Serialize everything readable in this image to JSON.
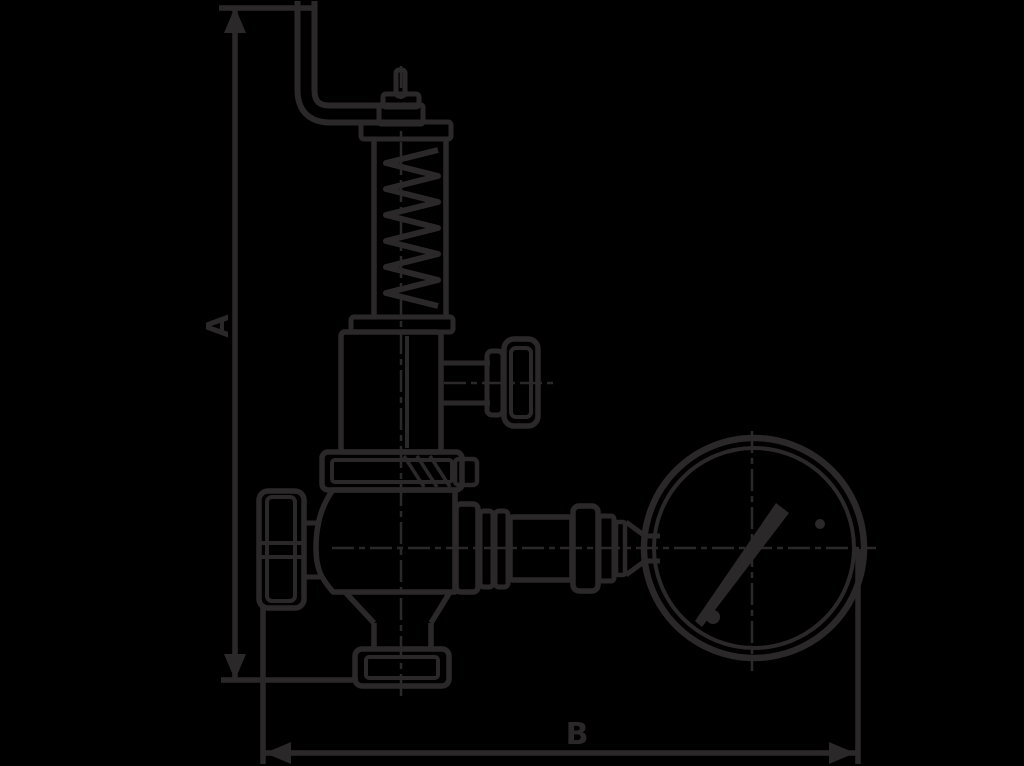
{
  "figure": {
    "type": "technical line drawing",
    "background_color": "#000000",
    "line_color": "#2b2829"
  },
  "dimensions": {
    "vertical_label": "A",
    "horizontal_label": "B"
  },
  "components": [
    "lifting-lever-bracket",
    "adjusting-pin",
    "spring-housing",
    "coil-spring",
    "bonnet",
    "side-port-knob",
    "upper-flange",
    "valve-body",
    "left-hand-knob",
    "bottom-outlet-flange",
    "pipe-union-fittings",
    "pressure-gauge",
    "gauge-needle"
  ]
}
